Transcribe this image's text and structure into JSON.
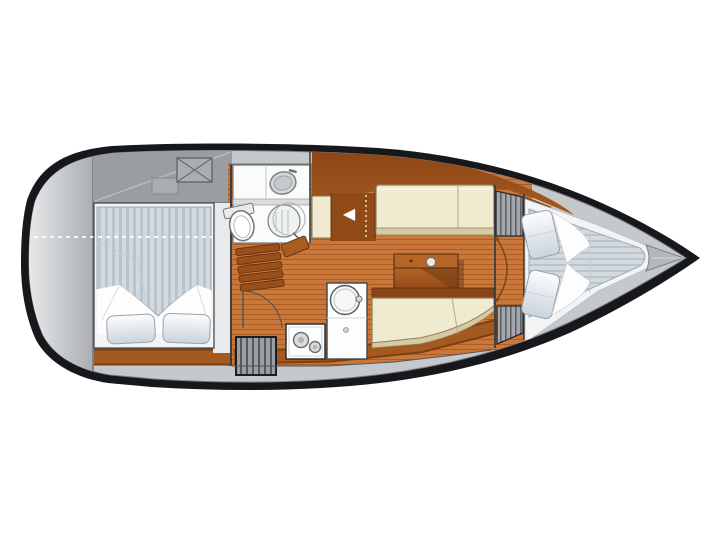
{
  "title": "Sailboat interior floor plan (top view)",
  "icons": {
    "companionway_arrow": "◀"
  },
  "colors": {
    "background": "#ffffff",
    "hull_outline": "#16181b",
    "hull_band": "#c6c9cb",
    "transom_light": "#eff0f1",
    "transom_dark": "#a9adb1",
    "deck_gray": "#9a9da1",
    "wood_floor": "#c9783a",
    "wood_plank_line": "#ab5c27",
    "wood_trim": "#a45a1e",
    "wood_trim_edge": "#7a4012",
    "cabinet_brown": "#8f4a18",
    "coachroof_dark": "#8a4315",
    "coachroof_light": "#a65a20",
    "settee_cream": "#f0ead0",
    "settee_trim": "#d9c9a1",
    "table_light": "#b46527",
    "table_dark": "#8a4516",
    "mattress_light": "#d3dade",
    "mattress_stripe": "#b9c4cc",
    "pillow_white": "#fdfdfe",
    "pillow_shade": "#c9d3de",
    "fixture_white": "#fafbfb",
    "hatch_gray": "#a3a6aa",
    "hatch_line": "#5f6266",
    "steps_gray": "#9b9ea2",
    "steps_line": "#54575b",
    "wall_line": "#3c3e40",
    "arrow_white": "#ffffff"
  }
}
